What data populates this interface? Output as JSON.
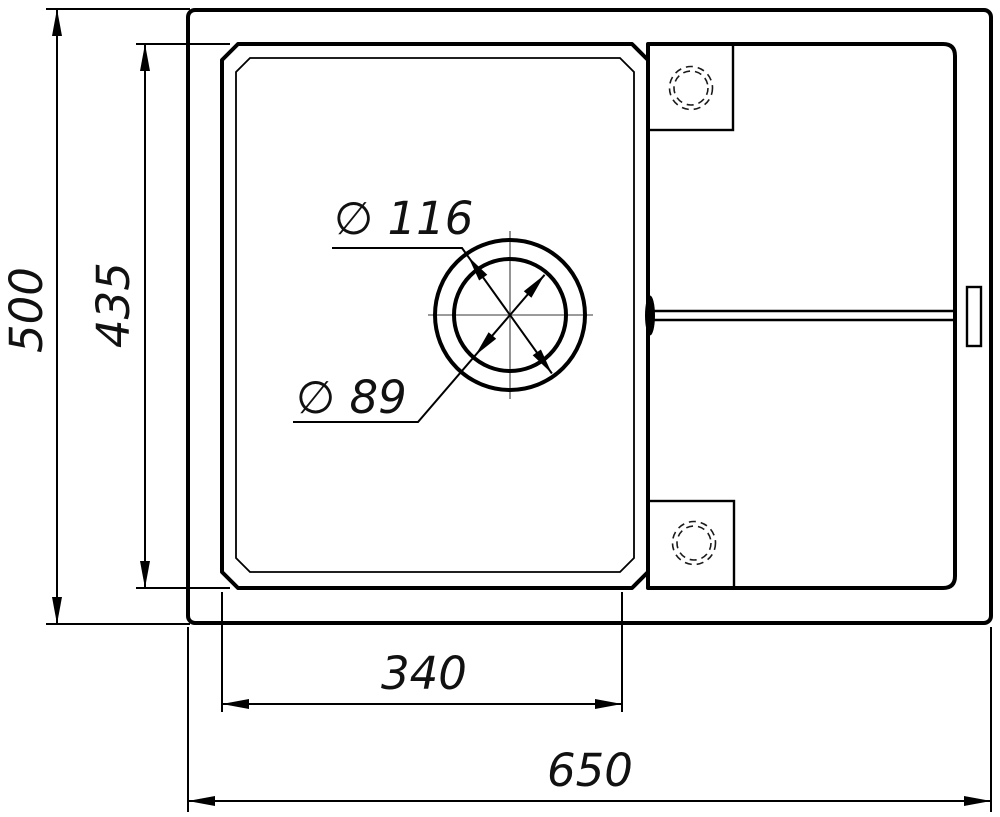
{
  "drawing": {
    "colors": {
      "background": "#ffffff",
      "line": "#000000",
      "centerline": "#7a7a7a"
    },
    "dimensions": {
      "overall_height": {
        "label": "500"
      },
      "bowl_height": {
        "label": "435"
      },
      "bowl_width": {
        "label": "340"
      },
      "overall_width": {
        "label": "650"
      },
      "drain_outer": {
        "label": "∅ 116"
      },
      "drain_inner": {
        "label": "∅ 89"
      }
    }
  }
}
